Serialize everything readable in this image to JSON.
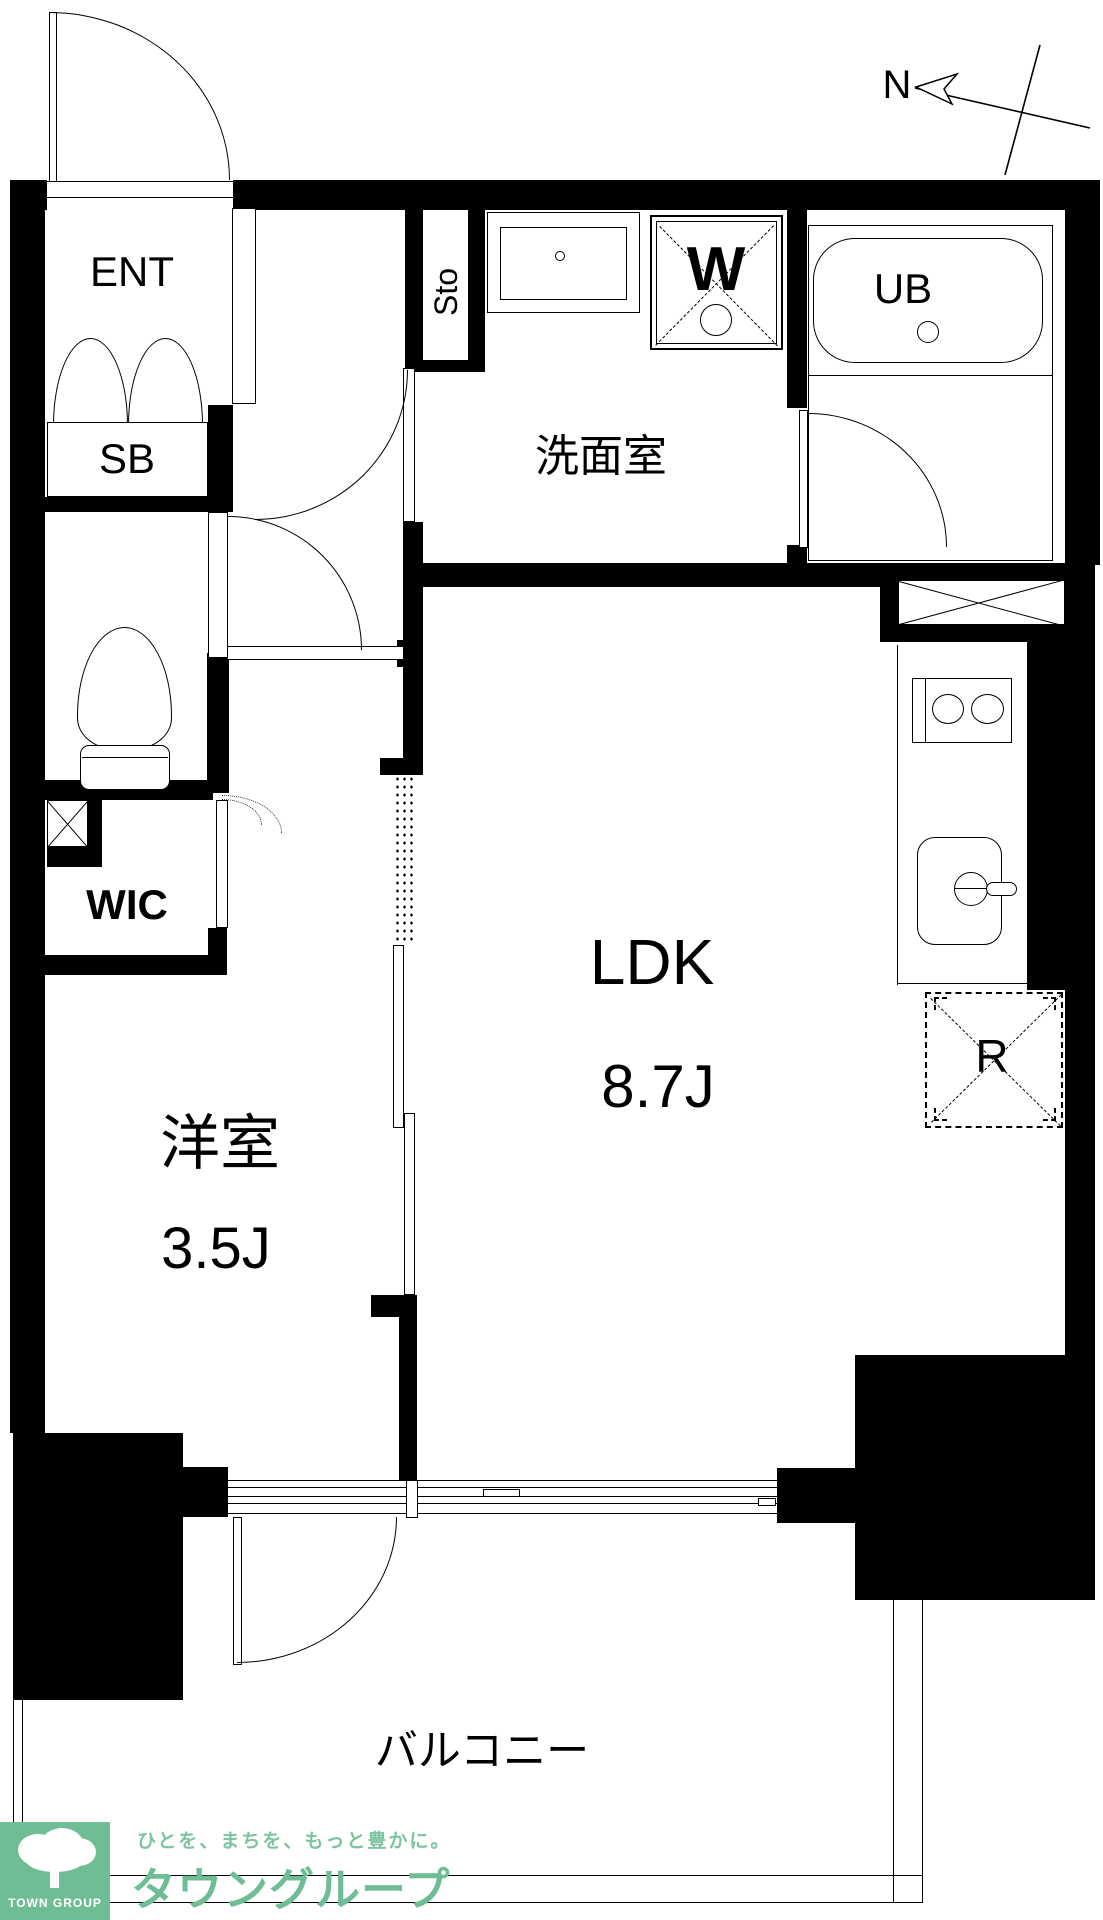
{
  "compass": {
    "north": "N"
  },
  "rooms": {
    "entrance": "ENT",
    "shoe_box": "SB",
    "storage": "Sto",
    "washroom": "洗面室",
    "washing_machine": "W",
    "unit_bath": "UB",
    "walk_in_closet": "WIC",
    "living_dining_kitchen": "LDK",
    "living_dining_kitchen_size": "8.7J",
    "western_room": "洋室",
    "western_room_size": "3.5J",
    "refrigerator_space": "R",
    "balcony": "バルコニー"
  },
  "branding": {
    "logo_text": "TOWN GROUP",
    "tagline": "ひとを、まちを、もっと豊かに。",
    "company": "タウングループ",
    "brand_color": "#6ebd95",
    "tagline_color": "#7cc4a1",
    "wall_color": "#000000"
  }
}
